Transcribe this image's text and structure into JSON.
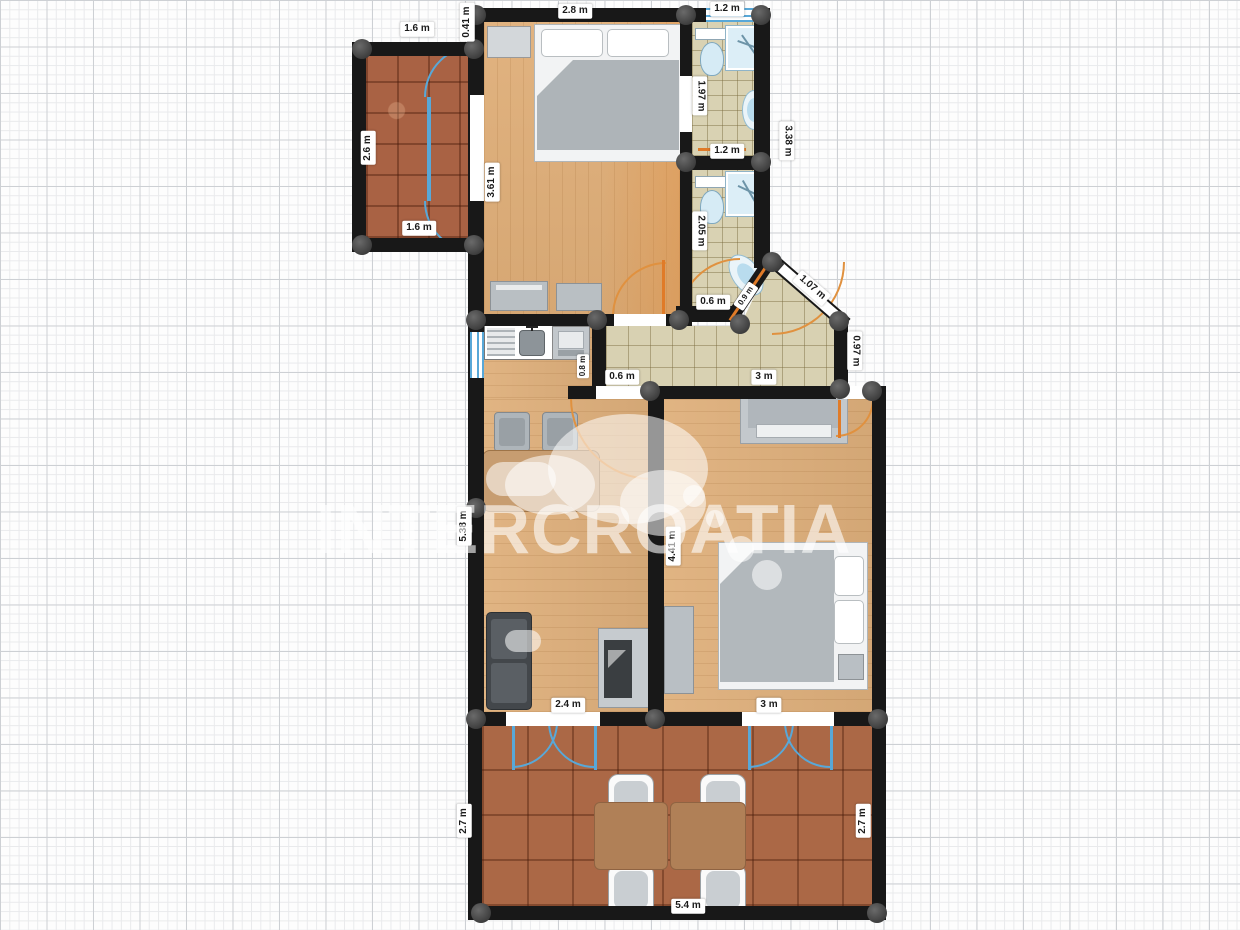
{
  "watermark": {
    "text": "INTERCROATIA"
  },
  "plan": {
    "unit": "m",
    "labels": {
      "balcony_top": "1.6 m",
      "balcony_left": "2.6 m",
      "balcony_bottom": "1.6 m",
      "bedroom1_wall_offset": "0.41 m",
      "bedroom1_top": "2.8 m",
      "bathroom1_top": "1.2 m",
      "bedroom1_left": "3.61 m",
      "bathroom1_left": "1.97 m",
      "bathroom1_bottom": "1.2 m",
      "bathrooms_right": "3.38 m",
      "bathroom2_left": "2.05 m",
      "bathroom2_bottom": "0.6 m",
      "bathroom2_diagonal": "0.9 m",
      "entrance_diagonal": "1.07 m",
      "entry_right_wall": "0.97 m",
      "hallway_left": "0.6 m",
      "hallway_right": "3 m",
      "kitchen_wall": "0.8 m",
      "living_left_wall": "5.38 m",
      "middle_wall": "4.41 m",
      "living_room_bottom": "2.4 m",
      "bedroom2_bottom": "3 m",
      "terrace_left": "2.7 m",
      "terrace_right": "2.7 m",
      "terrace_bottom": "5.4 m"
    },
    "colors": {
      "wall": "#181818",
      "wood_floor": "#dfb07c",
      "bathroom_tile": "#d9d2b3",
      "terracotta_tile": "#a96244",
      "window_blue": "#58a8d8",
      "door_orange": "#e07b28",
      "label_bg": "#ffffff",
      "furniture_gray": "#b9bfc4",
      "table_brown": "#b08057"
    }
  }
}
